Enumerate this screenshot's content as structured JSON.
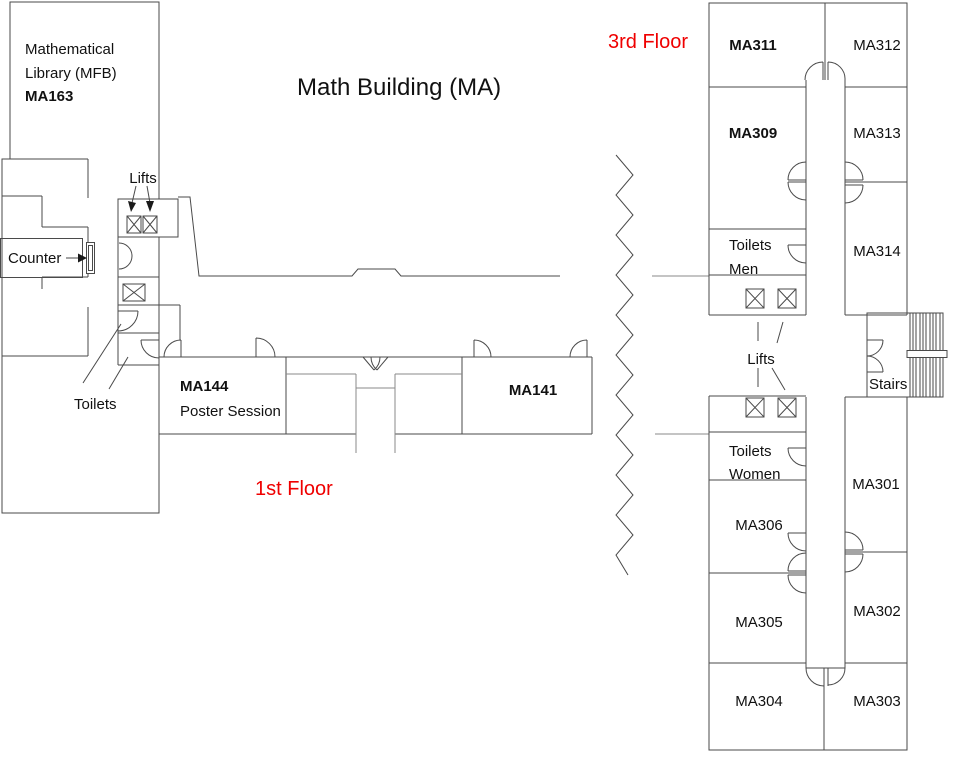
{
  "title": "Math Building (MA)",
  "floor_labels": {
    "first": "1st Floor",
    "third": "3rd Floor"
  },
  "library": {
    "name_line1": "Mathematical",
    "name_line2": "Library (MFB)",
    "room": "MA163"
  },
  "first_floor": {
    "lifts": "Lifts",
    "counter": "Counter",
    "toilets": "Toilets",
    "rooms": {
      "ma144": "MA144",
      "ma144_subtitle": "Poster Session",
      "ma141": "MA141"
    }
  },
  "third_floor": {
    "lifts": "Lifts",
    "stairs": "Stairs",
    "toilets_men": {
      "line1": "Toilets",
      "line2": "Men"
    },
    "toilets_women": {
      "line1": "Toilets",
      "line2": "Women"
    },
    "rooms": {
      "ma311": "MA311",
      "ma312": "MA312",
      "ma309": "MA309",
      "ma313": "MA313",
      "ma314": "MA314",
      "ma301": "MA301",
      "ma302": "MA302",
      "ma303": "MA303",
      "ma304": "MA304",
      "ma305": "MA305",
      "ma306": "MA306"
    }
  },
  "icons": {
    "lift": "crossed-box-icon",
    "door": "quarter-arc-door-icon",
    "stairs": "hatched-treads-icon",
    "floor_break": "zigzag-break-icon",
    "pointer": "arrow-pointer-icon"
  },
  "colors": {
    "wall": "#4a4a4a",
    "wall_light": "#8a8a8a",
    "accent_red": "#ef0000",
    "text": "#111111",
    "background": "#ffffff"
  }
}
